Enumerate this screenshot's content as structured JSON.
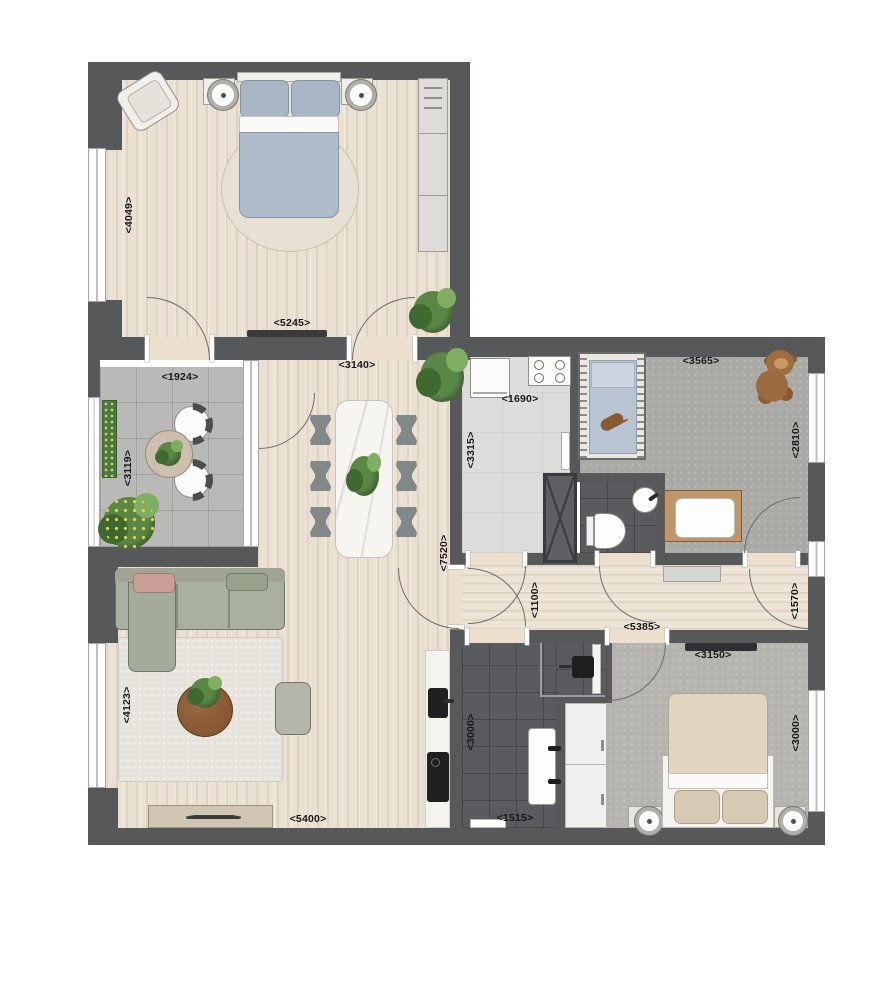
{
  "colors": {
    "wall": "#57585a",
    "wood_floor": "#ebe1d2",
    "balcony_tile": "#b9bab8",
    "utility_floor": "#dcdcda",
    "kids_carpet": "#a9a9a6",
    "bedroom_carpet": "#b5b3ae",
    "bath_tile": "#5a5b5f",
    "marble": "#f6f5f2",
    "plant_green": "#5a8746",
    "dim_text": "#17171a"
  },
  "dim_labels": {
    "master_bedroom": {
      "height": "<4049>",
      "width": "<5245>"
    },
    "balcony": {
      "width": "<1924>",
      "height": "<3119>"
    },
    "dining": {
      "width": "<3140>"
    },
    "open_area": {
      "height": "<7520>"
    },
    "utility": {
      "width": "<1690>",
      "height": "<3315>"
    },
    "kids_room": {
      "width": "<3565>",
      "height": "<2810>"
    },
    "vestibule": {
      "width": "<1100>"
    },
    "hallway": {
      "length": "<5385>",
      "entry_depth": "<1570>"
    },
    "bedroom2": {
      "width": "<3150>",
      "height": "<3000>"
    },
    "living_room": {
      "height": "<4123>",
      "width": "<5400>"
    },
    "bathroom": {
      "height": "<3000>",
      "width": "<1515>"
    }
  },
  "icons": [
    "double-bed-icon",
    "crib-icon",
    "teddy-bear-icon",
    "sofa-icon",
    "dining-table-icon",
    "toilet-icon",
    "shower-icon",
    "washbasin-icon",
    "washing-machine-icon",
    "hob-icon",
    "plant-icon",
    "door-arc-icon",
    "window-icon",
    "wardrobe-icon",
    "coffee-table-icon"
  ]
}
